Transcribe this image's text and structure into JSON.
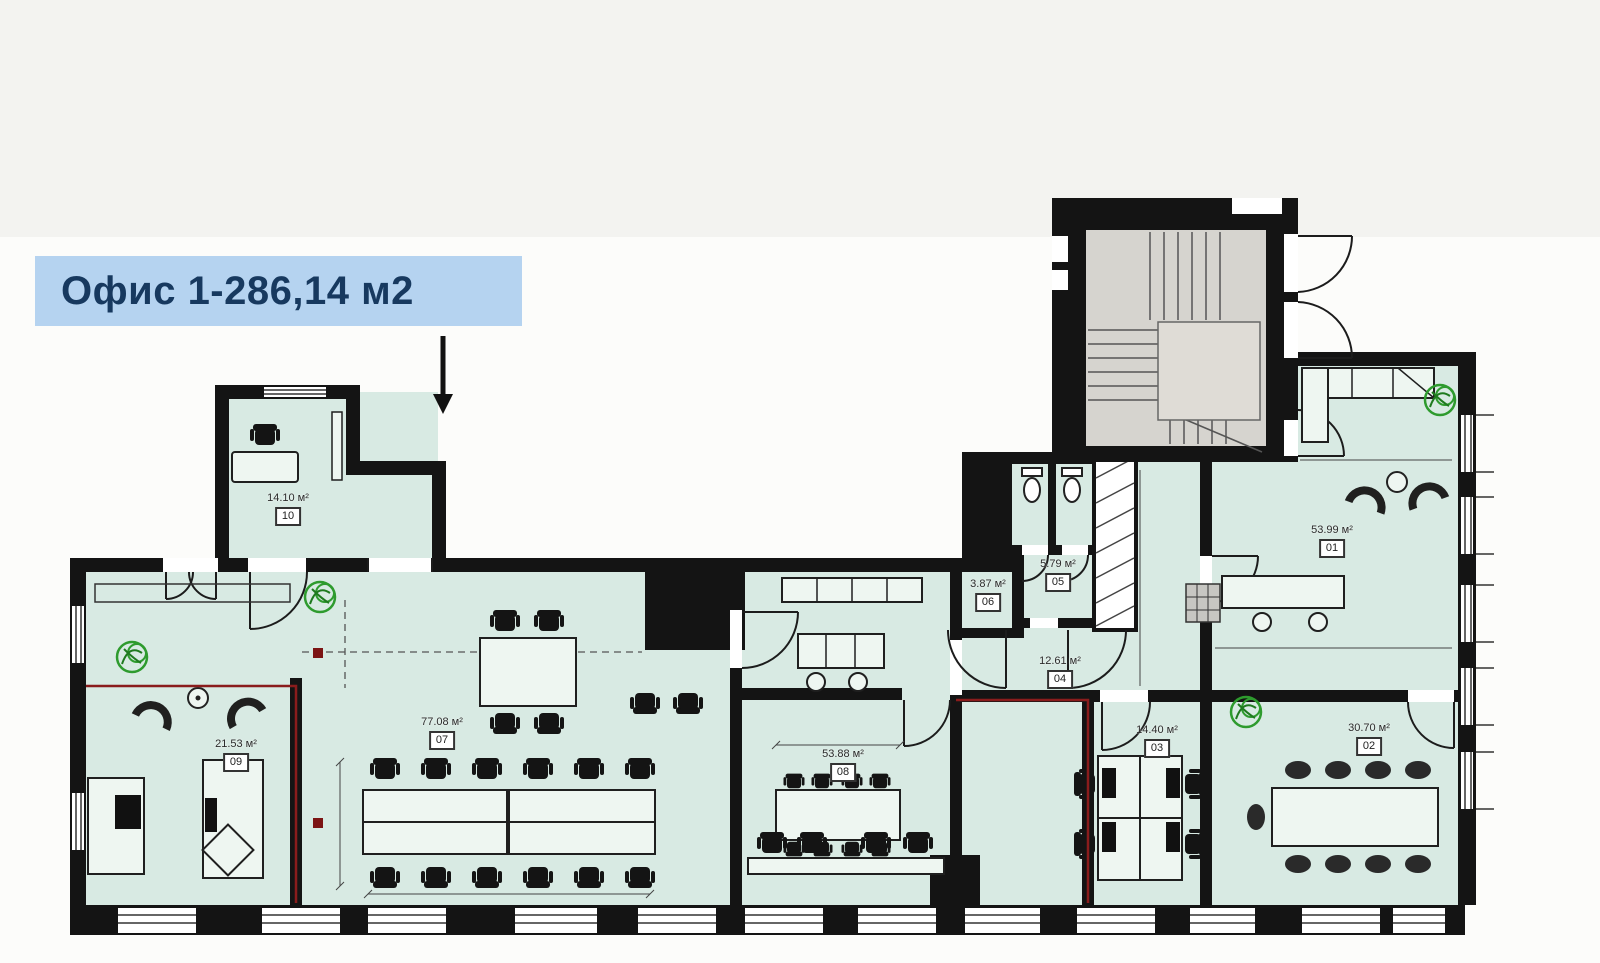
{
  "header": {
    "title": "Офис 1-286,14 м2"
  },
  "plan": {
    "rooms": {
      "r01": {
        "number": "01",
        "area": "53.99 м²"
      },
      "r02": {
        "number": "02",
        "area": "30.70 м²"
      },
      "r03": {
        "number": "03",
        "area": "14.40 м²"
      },
      "r04": {
        "number": "04",
        "area": "12.61 м²"
      },
      "r05": {
        "number": "05",
        "area": "5.79 м²"
      },
      "r06": {
        "number": "06",
        "area": "3.87 м²"
      },
      "r07": {
        "number": "07",
        "area": "77.08 м²"
      },
      "r08": {
        "number": "08",
        "area": "53.88 м²"
      },
      "r09": {
        "number": "09",
        "area": "21.53 м²"
      },
      "r10": {
        "number": "10",
        "area": "14.10 м²"
      }
    },
    "colors": {
      "label_bg": "#b5d3f0",
      "label_text": "#17395f",
      "room_fill": "#d8eae3",
      "wall": "#141414",
      "stair_fill": "#d6d4cf",
      "plant_green": "#2e9b2e",
      "boundary_red": "#8a1c1c"
    }
  }
}
